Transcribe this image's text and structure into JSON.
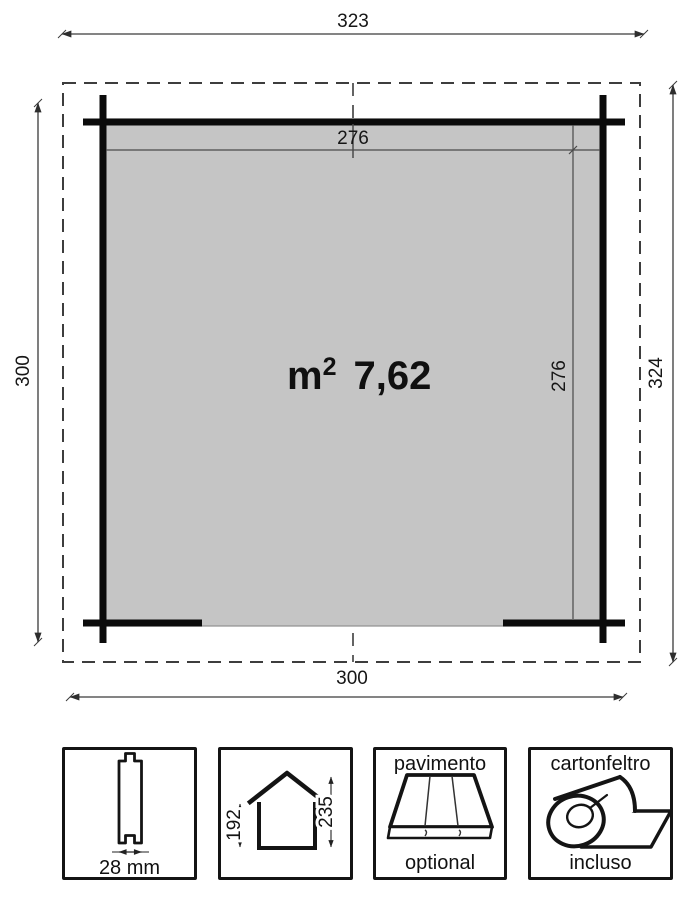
{
  "colors": {
    "floor": "#c5c5c5",
    "wall": "#0b0b0b",
    "line": "#3a3a3a"
  },
  "plan": {
    "width_total": "323",
    "depth_left": "300",
    "depth_right": "324",
    "width_bottom": "300",
    "inner_width": "276",
    "inner_depth": "276",
    "area_unit": "m",
    "area_exp": "2",
    "area_value": "7,62"
  },
  "legend": {
    "wall_thickness": {
      "label": "28 mm"
    },
    "heights": {
      "eave": "192",
      "ridge": "235"
    },
    "floor": {
      "title": "pavimento",
      "status": "optional"
    },
    "roof_felt": {
      "title": "cartonfeltro",
      "status": "incluso"
    }
  }
}
